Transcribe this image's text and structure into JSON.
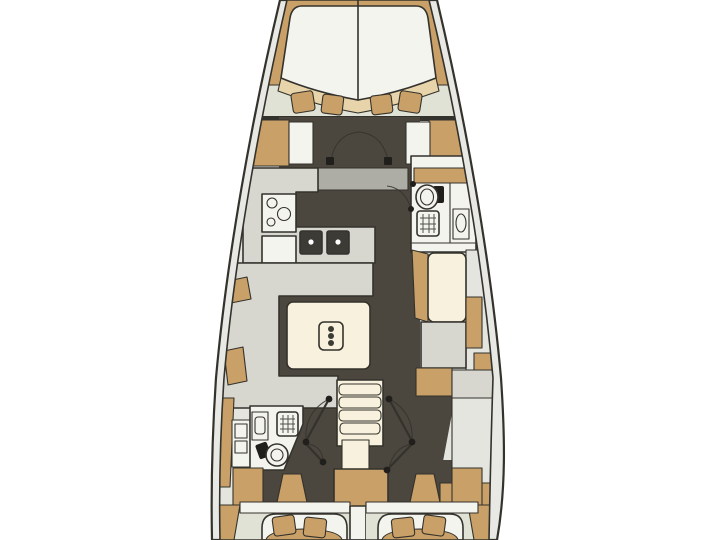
{
  "diagram": {
    "type": "yacht-interior-floor-plan",
    "orientation": "bow-at-top",
    "areas": [
      "forward-owner-cabin",
      "forward-v-berth",
      "forward-lockers",
      "galley",
      "stove",
      "galley-sink",
      "double-sink",
      "forward-head",
      "toilet",
      "shower-grate",
      "washbasin",
      "salon-settee",
      "salon-table",
      "table-centerpiece",
      "chart-seat",
      "chart-desk",
      "companionway-stairs",
      "aft-head",
      "aft-head-toilet",
      "aft-cabin-port",
      "aft-cabin-starboard",
      "double-berth",
      "pillows"
    ]
  },
  "palette": {
    "outline": "#34322c",
    "hullgap": "#e8e9e4",
    "base": "#e4e5df",
    "charcoal": "#4b463e",
    "pale": "#dfe2d4",
    "gray": "#d7d7d0",
    "midgray": "#aeada5",
    "white": "#f4f4ef",
    "cream": "#f7f1de",
    "wood": "#c9a067",
    "woodlight": "#e7d4aa",
    "black": "#211f1b",
    "sinkdark": "#3d3b35"
  }
}
